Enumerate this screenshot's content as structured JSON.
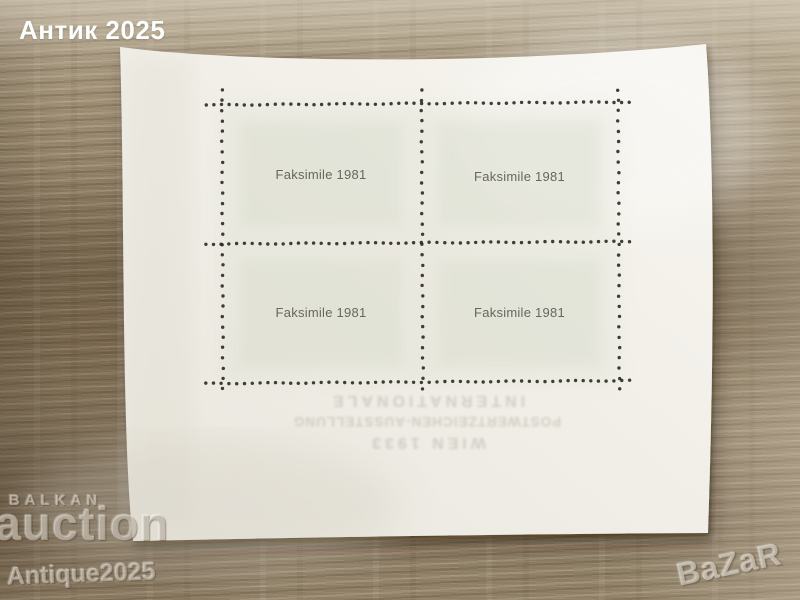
{
  "watermarks": {
    "top_left": "Антик 2025",
    "seller_small": "BALKAN",
    "seller_large": "auction",
    "seller_sub": "Antique2025",
    "corner_logo": "BaZaR"
  },
  "sheet": {
    "stamps": [
      {
        "label": "Faksimile 1981"
      },
      {
        "label": "Faksimile 1981"
      },
      {
        "label": "Faksimile 1981"
      },
      {
        "label": "Faksimile 1981"
      }
    ],
    "showthrough_lines": [
      "INTERNATIONALE",
      "POSTWERTZEICHEN-AUSSTELLUNG",
      "WIEN 1933"
    ]
  },
  "colors": {
    "wood_base": "#8c7b62",
    "wood_light": "#c8bba2",
    "wood_dark": "#6b5a42",
    "paper": "#efede6",
    "paper_bright": "#f6f4ee",
    "paper_shade": "#e6e3da",
    "stamp_tint": "#d9dccd",
    "stamp_text": "#67665f",
    "perforation_dot": "#26231f",
    "watermark_white": "#fcfdfd"
  }
}
